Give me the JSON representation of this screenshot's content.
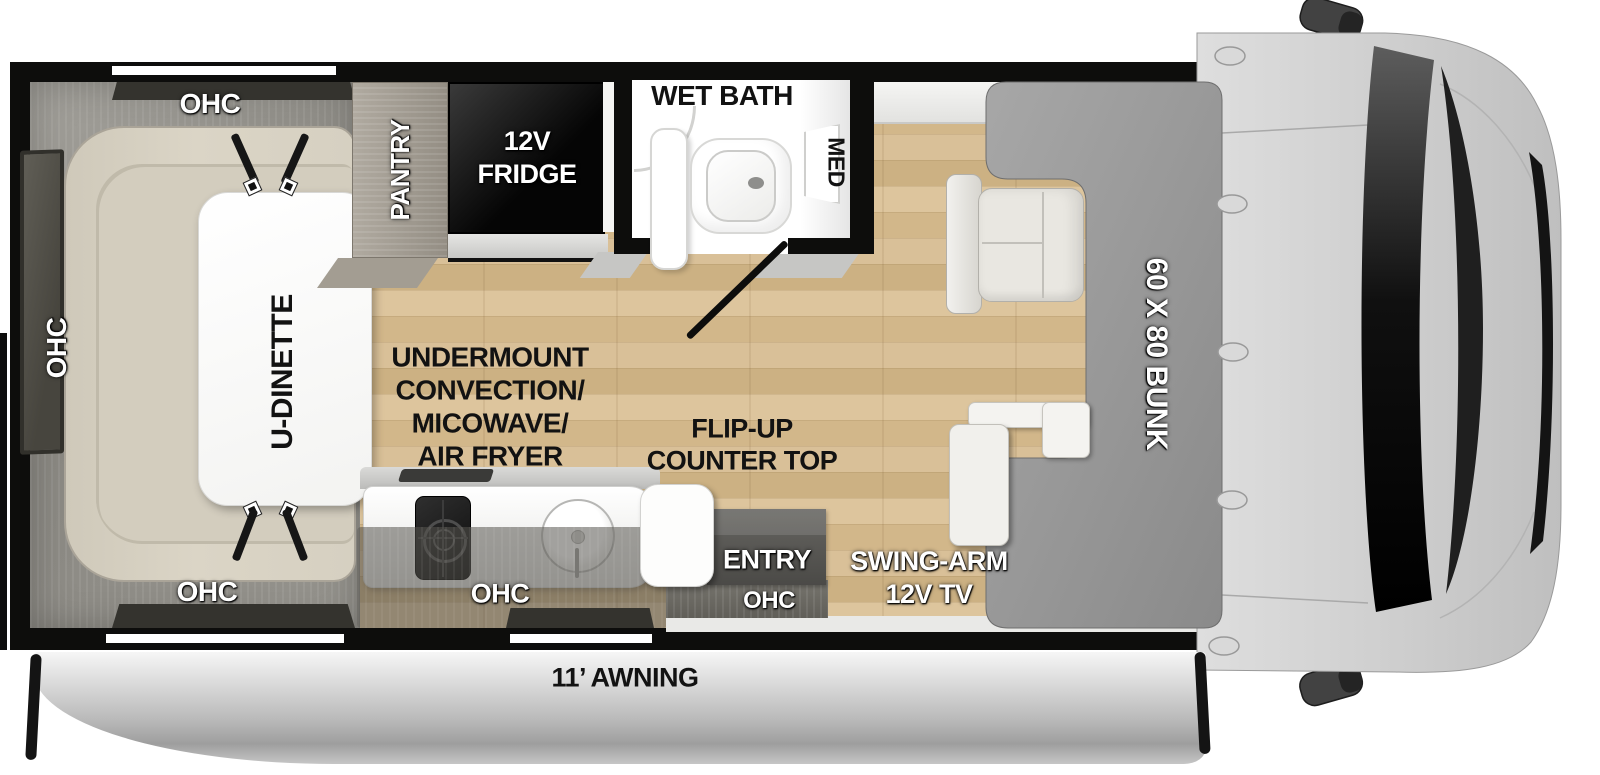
{
  "floorplan": {
    "dinette": {
      "ohc_top": "OHC",
      "ohc_side": "OHC",
      "ohc_bottom": "OHC",
      "table_label": "U-DINETTE"
    },
    "storage": {
      "pantry_label": "PANTRY",
      "fridge_line1": "12V",
      "fridge_line2": "FRIDGE"
    },
    "bath": {
      "room_label": "WET BATH",
      "cabinet_label": "MED"
    },
    "kitchen": {
      "appliance_line1": "UNDERMOUNT",
      "appliance_line2": "CONVECTION/",
      "appliance_line3": "MICOWAVE/",
      "appliance_line4": "AIR FRYER",
      "flip_counter_line1": "FLIP-UP",
      "flip_counter_line2": "COUNTER TOP",
      "ohc_label": "OHC"
    },
    "entry": {
      "door_label": "ENTRY",
      "ohc_label": "OHC"
    },
    "media": {
      "tv_line1": "SWING-ARM",
      "tv_line2": "12V TV"
    },
    "cabover": {
      "bunk_label": "60 X 80 BUNK"
    },
    "exterior": {
      "awning_label": "11’ AWNING"
    }
  },
  "colors": {
    "floor_wood": "#d8c096",
    "wall_black": "#0d0d0c",
    "cabinet_gray": "#94928c",
    "cushion_cream": "#d8d2c3",
    "pantry_wood": "#a7a198",
    "fridge_black": "#0b0b0b",
    "bath_white": "#ffffff",
    "bunk_gray": "#9a9a9a",
    "cab_gray": "#d2d2d2",
    "awning_silver": "#c6c6c6",
    "label_white": "#ffffff",
    "label_black": "#121212"
  }
}
